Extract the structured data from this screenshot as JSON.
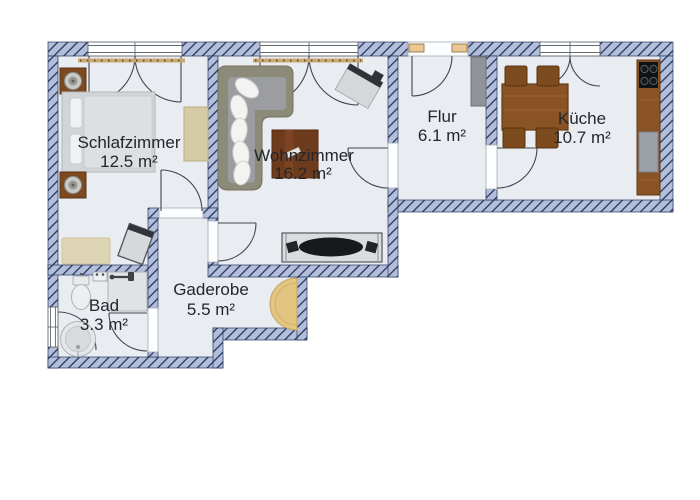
{
  "plan": {
    "type": "apartment-floor-plan",
    "colors": {
      "wall_fill": "#b3bfda",
      "wall_stripe": "#25355c",
      "floor": "#e9ecf0",
      "background": "#ffffff",
      "label_text": "#23272b",
      "wood": "#8a5326",
      "curtain_rail": "#c9a873",
      "wardrobe_tan": "#e3c480"
    },
    "rooms": [
      {
        "id": "schlafzimmer",
        "name": "Schlafzimmer",
        "area": "12.5 m²",
        "furniture": [
          "double-bed",
          "nightstand",
          "nightstand",
          "table-lamp",
          "table-lamp",
          "dresser",
          "rug",
          "chair"
        ]
      },
      {
        "id": "wohnzimmer",
        "name": "Wohnzimmer",
        "area": "16.2 m²",
        "furniture": [
          "corner-sofa",
          "pillows",
          "coffee-table",
          "desk",
          "desk-chair",
          "tv-lowboard",
          "tv",
          "speakers",
          "curtain-rail"
        ]
      },
      {
        "id": "flur",
        "name": "Flur",
        "area": "6.1 m²",
        "furniture": [
          "wardrobe"
        ]
      },
      {
        "id": "kueche",
        "name": "Küche",
        "area": "10.7 m²",
        "furniture": [
          "dining-table",
          "chair",
          "chair",
          "chair",
          "chair",
          "kitchen-counter",
          "cooktop",
          "sink"
        ]
      },
      {
        "id": "bad",
        "name": "Bad",
        "area": "3.3 m²",
        "furniture": [
          "toilet",
          "wash-basin",
          "shower",
          "round-bathtub"
        ]
      },
      {
        "id": "garderobe",
        "name": "Gaderobe",
        "area": "5.5 m²",
        "furniture": [
          "curved-wardrobe"
        ]
      }
    ],
    "openings": {
      "windows": 4,
      "doors": 6,
      "entrance_door": "top wall of Flur"
    }
  }
}
